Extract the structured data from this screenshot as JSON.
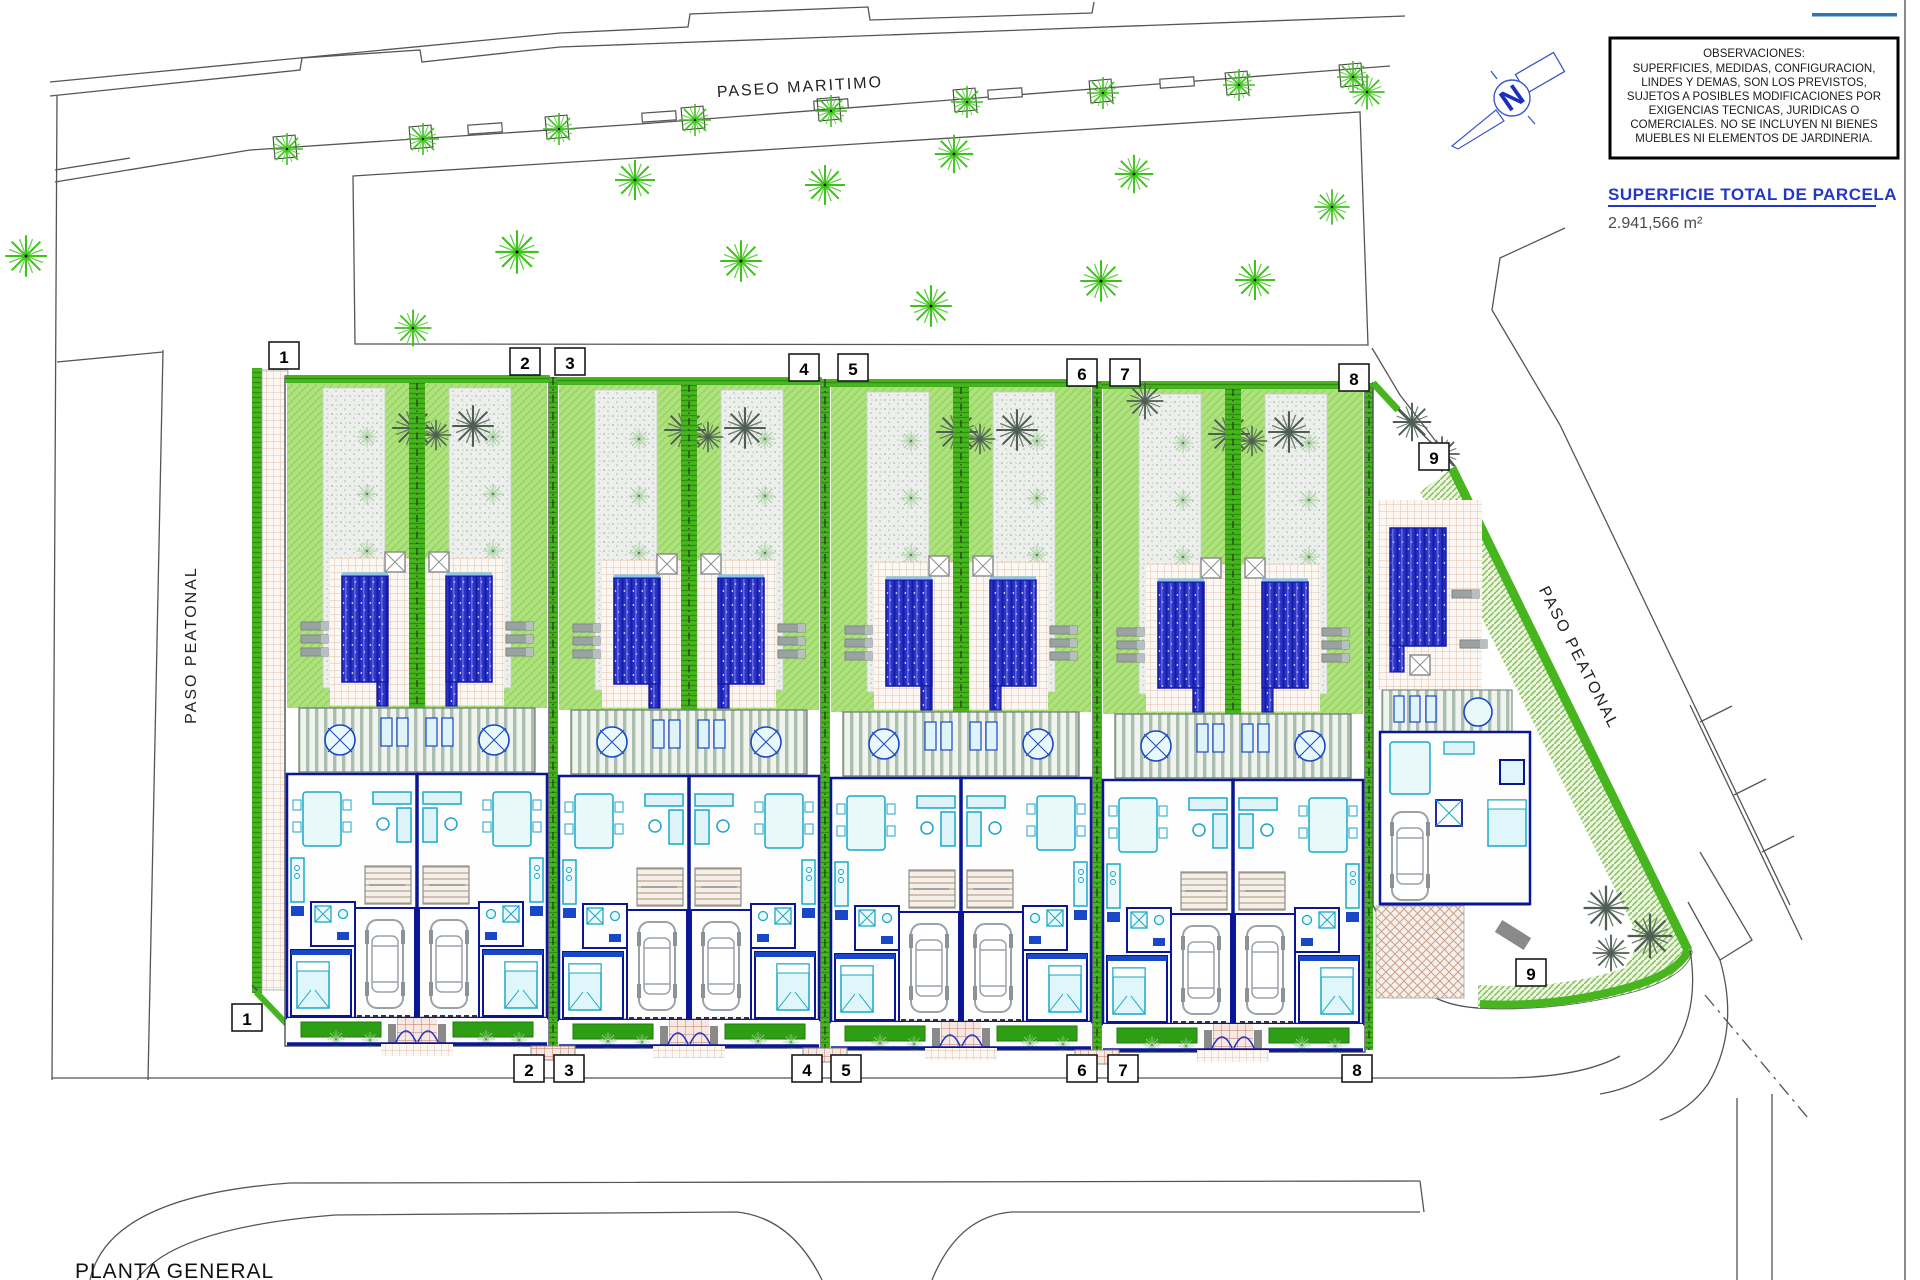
{
  "title_block": {
    "observaciones": [
      "OBSERVACIONES:",
      "SUPERFICIES, MEDIDAS, CONFIGURACION,",
      "LINDES Y DEMAS, SON LOS PREVISTOS,",
      "SUJETOS A POSIBLES MODIFICACIONES POR",
      "EXIGENCIAS TECNICAS, JURIDICAS O",
      "COMERCIALES. NO SE INCLUYEN NI BIENES",
      "MUEBLES NI ELEMENTOS DE JARDINERIA."
    ],
    "superficie_label": "SUPERFICIE TOTAL DE PARCELA",
    "superficie_value": "2.941,566 m²"
  },
  "labels": {
    "paseo_maritimo": "PASEO MARITIMO",
    "paso_peatonal_left": "PASO PEATONAL",
    "paso_peatonal_right": "PASO PEATONAL",
    "planta_general": "PLANTA GENERAL",
    "north": "N"
  },
  "plates": {
    "top": [
      "1",
      "2",
      "3",
      "4",
      "5",
      "6",
      "7",
      "8",
      "9"
    ],
    "bottom": [
      "1",
      "2",
      "3",
      "4",
      "5",
      "6",
      "7",
      "8",
      "9"
    ]
  },
  "colors": {
    "accent_blue": "#2e75b6",
    "cad_blue": "#0a1694",
    "furniture_cyan": "#18a8c8",
    "hedge_green": "#46b51e",
    "lawn_green": "#aee080",
    "pool_blue": "#2b33c4",
    "palm_dark": "#4e5e52",
    "palm_green": "#3ec21c"
  }
}
